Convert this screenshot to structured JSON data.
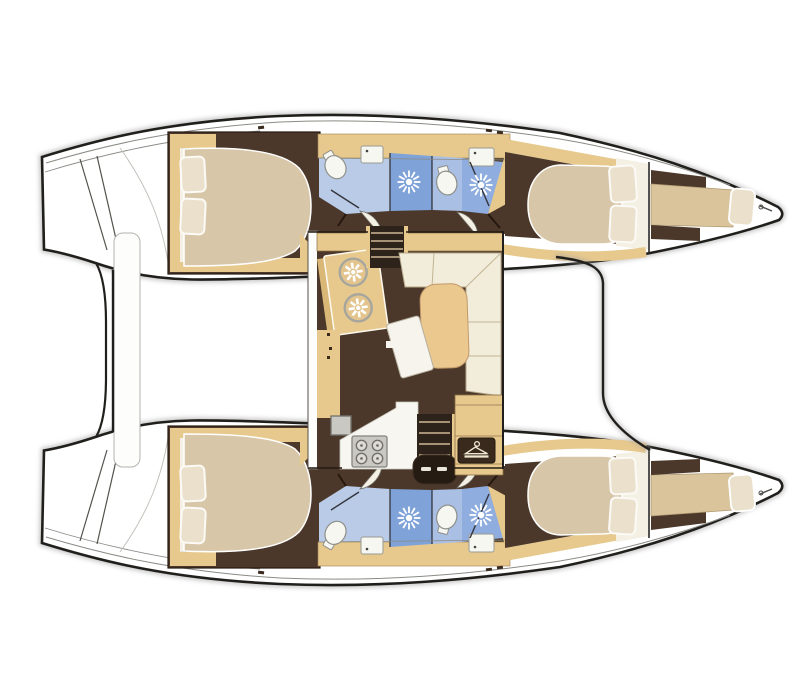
{
  "page": {
    "title": "Catamaran interior floor plan — top-down layout",
    "background": "#ffffff"
  },
  "colors": {
    "outline": "#211f1c",
    "shadow": "#9e9e9e",
    "hullWhite": "#ffffff",
    "deckLine": "#8b8b86",
    "floorBrown": "#4b382a",
    "wood": "#e7c98e",
    "woodDeep": "#d9b877",
    "woodLight": "#d9c49c",
    "bedCream": "#d8c6a8",
    "pillowCream": "#eae0cb",
    "sheetWhite": "#f4f0e3",
    "bathLight": "#b9cbe7",
    "bathMid": "#a9bfe4",
    "showerBlue": "#7fa3d8",
    "showerMid": "#8fadde",
    "glassLine": "#34343c",
    "porcelain": "#f7f7f2",
    "counterWhite": "#f7f6f1",
    "stoveGray": "#c9c8c3",
    "burnerGray": "#dddcd6",
    "stairDark": "#2e231a",
    "stepLine": "#cdb896",
    "landingDark": "#251b12",
    "sofaCream": "#f2ecdb",
    "tableTan": "#ebc98e",
    "stoolWhite": "#f6f4ec",
    "platformWhite": "#fdfdfc",
    "markDark": "#3a2a1e",
    "dashLight": "#e9e5da",
    "sinkRound": "#e2c48c"
  },
  "plan": {
    "vessel_type": "catamaran",
    "view": "top-down interior layout",
    "orientation": {
      "bows": "right (pointed tips)",
      "sterns": "left (swim platforms)"
    },
    "hulls": [
      {
        "name": "port hull (top)",
        "rooms": [
          "aft double cabin",
          "aft bathroom with shower",
          "forward bathroom with shower",
          "forward double cabin",
          "forepeak berth"
        ]
      },
      {
        "name": "starboard hull (bottom)",
        "rooms": [
          "aft double cabin",
          "aft bathroom with shower",
          "forward bathroom with shower",
          "forward double cabin",
          "forepeak berth"
        ]
      }
    ],
    "saloon_features": [
      "galley with twin round sinks",
      "four-burner stove",
      "galley counter",
      "companionway stairs to port hull",
      "companionway stairs to starboard hull",
      "L-shaped sofa",
      "dining table",
      "movable stool",
      "wardrobe hanging locker"
    ],
    "deck_features": [
      "twin pointed bows",
      "stern swim platform steps",
      "aft platform between hulls",
      "foredeck boundary line"
    ]
  },
  "icons": {
    "shower": "sunburst-shower-head-icon",
    "wardrobe": "clothes-hanger-icon",
    "stove": "four-burner-stove-icon",
    "round_sink": "round-sink-flower-icon",
    "toilet": "toilet-icon"
  },
  "counts": {
    "double_beds": 4,
    "forepeak_berths": 2,
    "pillows": 10,
    "bathrooms": 4,
    "shower_heads": 4,
    "toilets": 4,
    "bathroom_sinks": 4
  }
}
